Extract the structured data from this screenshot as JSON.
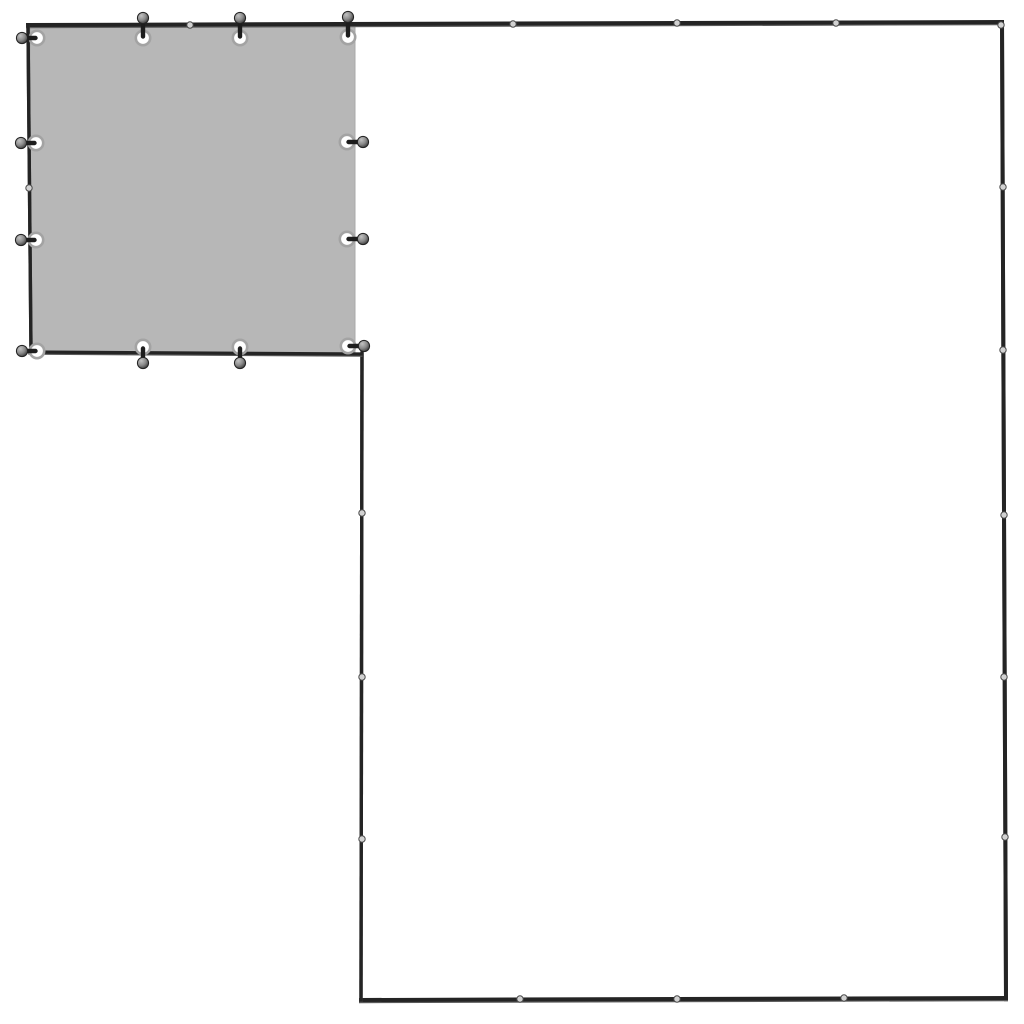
{
  "scene": {
    "alt": "Top view of an L-shaped kennel frame with a gray tarp cover fastened to the top-left square section",
    "background_color": "#ffffff",
    "colors": {
      "rail": "#242424",
      "rail_edge": "#5a5a5a",
      "joint_fill": "#d2d2d2",
      "joint_stroke": "#4a4a4a",
      "tarp_fill": "#b7b7b7",
      "tarp_edge": "#a8a8a8",
      "eyelet_fill": "#ffffff",
      "eyelet_ring": "#a3a3a3",
      "stem": "#1d1d1d",
      "ball_light": "#c2c2c2",
      "ball_mid": "#8a8a8a",
      "ball_dark": "#3a3a3a",
      "ball_stroke": "#222222"
    },
    "tarp": {
      "x": 30,
      "y": 26,
      "width": 325,
      "height": 327
    },
    "rails": [
      {
        "id": "top-rail",
        "x1": 28,
        "y1": 25,
        "x2": 1002,
        "y2": 22,
        "w": 4
      },
      {
        "id": "right-rail",
        "x1": 1002,
        "y1": 22,
        "x2": 1006,
        "y2": 998,
        "w": 4
      },
      {
        "id": "bottom-rail",
        "x1": 361,
        "y1": 1000,
        "x2": 1006,
        "y2": 998,
        "w": 4
      },
      {
        "id": "inner-vertical-rail",
        "x1": 362,
        "y1": 353,
        "x2": 361,
        "y2": 1000,
        "w": 3.4
      },
      {
        "id": "left-rail",
        "x1": 28,
        "y1": 25,
        "x2": 31,
        "y2": 351,
        "w": 3.4
      },
      {
        "id": "tarp-bottom-rail",
        "x1": 30,
        "y1": 352,
        "x2": 361,
        "y2": 354,
        "w": 3.2
      }
    ],
    "joints": [
      {
        "x": 190,
        "y": 25
      },
      {
        "x": 513,
        "y": 24
      },
      {
        "x": 677,
        "y": 23
      },
      {
        "x": 836,
        "y": 23
      },
      {
        "x": 1001,
        "y": 25
      },
      {
        "x": 1003,
        "y": 187
      },
      {
        "x": 1003,
        "y": 350
      },
      {
        "x": 1004,
        "y": 515
      },
      {
        "x": 1004,
        "y": 677
      },
      {
        "x": 1005,
        "y": 837
      },
      {
        "x": 520,
        "y": 999
      },
      {
        "x": 677,
        "y": 999
      },
      {
        "x": 844,
        "y": 998
      },
      {
        "x": 362,
        "y": 513
      },
      {
        "x": 362,
        "y": 677
      },
      {
        "x": 362,
        "y": 839
      },
      {
        "x": 29,
        "y": 188
      }
    ],
    "joint_radius": 3.2,
    "eyelet": {
      "radius": 7.2,
      "ring_width": 2.6
    },
    "toggle": {
      "stem_width": 4.4,
      "ball_radius": 5.6,
      "offsets": {
        "up": 20,
        "down": 16,
        "left": 15,
        "right": 16
      }
    },
    "fasteners": [
      {
        "x": 37,
        "y": 38,
        "dir": "left"
      },
      {
        "x": 143,
        "y": 38,
        "dir": "up"
      },
      {
        "x": 240,
        "y": 38,
        "dir": "up"
      },
      {
        "x": 348,
        "y": 37,
        "dir": "up"
      },
      {
        "x": 36,
        "y": 143,
        "dir": "left"
      },
      {
        "x": 347,
        "y": 142,
        "dir": "right"
      },
      {
        "x": 36,
        "y": 240,
        "dir": "left"
      },
      {
        "x": 347,
        "y": 239,
        "dir": "right"
      },
      {
        "x": 37,
        "y": 351,
        "dir": "left"
      },
      {
        "x": 143,
        "y": 347,
        "dir": "down"
      },
      {
        "x": 240,
        "y": 347,
        "dir": "down"
      },
      {
        "x": 348,
        "y": 346,
        "dir": "right"
      }
    ]
  }
}
